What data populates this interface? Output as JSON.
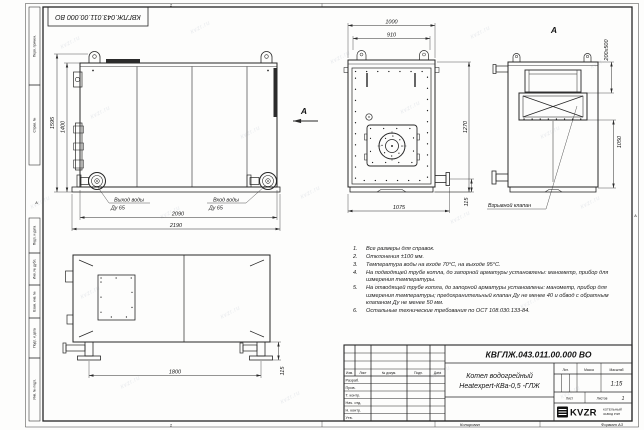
{
  "meta": {
    "doc_number": "КВГЛЖ.043.011.00.000 ВО",
    "format_label": "Формат А3",
    "copied_label": "Копировал",
    "zone_number": "2",
    "zone_letter": "А",
    "watermark": "kvzr.ru"
  },
  "frame": {
    "left_labels": [
      "Перв. примен.",
      "Справ. №",
      "Подп. и дата",
      "Инв. № дубл.",
      "Взам. инв. №",
      "Подп. и дата",
      "Инв. № подл."
    ]
  },
  "views": {
    "side": {
      "dim_height_total": "1595",
      "dim_height_body": "1400",
      "dim_width_body": "2090",
      "dim_width_total": "2190",
      "outlet_label": "Выход воды",
      "outlet_dn": "Ду 65",
      "inlet_label": "Вход воды",
      "inlet_dn": "Ду 65",
      "view_arrow_label": "А"
    },
    "front": {
      "dim_width_total": "1000",
      "dim_width_inner": "910",
      "dim_height": "1270",
      "dim_width_bottom": "1075",
      "dim_pipe_height": "115"
    },
    "rear": {
      "view_label": "А",
      "dim_opening": "200х500",
      "dim_height": "1050",
      "valve_label": "Взрывной клапан"
    },
    "top": {
      "dim_leg_span": "1800",
      "dim_leg_height": "115"
    }
  },
  "notes": [
    {
      "num": "1.",
      "text": "Все размеры для справок."
    },
    {
      "num": "2.",
      "text": "Отклонения ±100 мм."
    },
    {
      "num": "3.",
      "text": "Температура воды на входе 70°С, на выходе 95°С."
    },
    {
      "num": "4.",
      "text": "На подводящей трубе котла, до запорной арматуры установлены: манометр, прибор для измерения температуры."
    },
    {
      "num": "5.",
      "text": "На отводящей трубе котла, до запорной арматуры установлены: манометр, прибор для измерения температуры; предохранительный клапан Ду не менее 40 и обвод с обратным клапаном Ду не менее 50 мм."
    },
    {
      "num": "6.",
      "text": "Остальные технические требования по ОСТ 108.030.133-84."
    }
  ],
  "title_block": {
    "doc_number": "КВГЛЖ.043.011.00.000 ВО",
    "product_line1": "Котел водогрейный",
    "product_line2": "Heatexpert-КВа-0,5 -ГЛЖ",
    "col_izm": "Изм.",
    "col_list": "Лист",
    "col_docnum": "№ докум.",
    "col_podp": "Подп.",
    "col_data": "Дата",
    "row_razrab": "Разраб.",
    "row_prov": "Пров.",
    "row_tkontr": "Т. контр.",
    "row_nachotd": "Нач. отд.",
    "row_nkontr": "Н. контр.",
    "row_utv": "Утв.",
    "lit_label": "Лит.",
    "mass_label": "Масса",
    "scale_label": "Масштаб",
    "scale_value": "1:15",
    "sheet_label": "Лист",
    "sheets_label": "Листов",
    "sheets_value": "1",
    "logo_text": "KVZR",
    "company_line1": "КОТЕЛЬНЫЙ",
    "company_line2": "ЗАВОД РЭП"
  }
}
